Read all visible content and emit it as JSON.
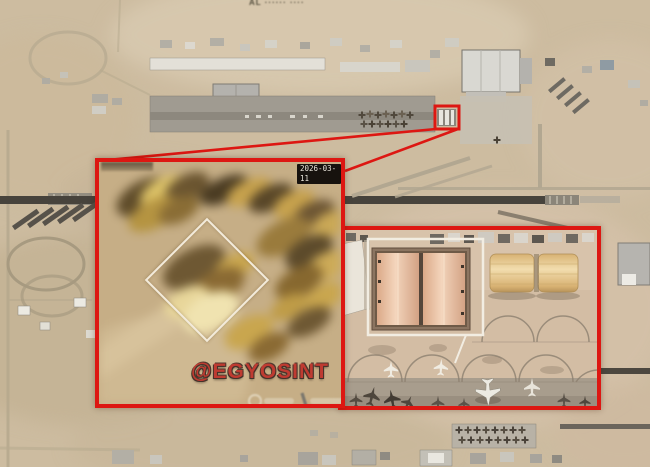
{
  "main_map": {
    "place_label": "AL ······ ····"
  },
  "left_inset": {
    "date_label": "2026-03-11",
    "watermark": "@EGYOSINT"
  },
  "colors": {
    "annotation_red": "#dd1712",
    "annotation_white": "#f2ede2",
    "watermark_red": "#bf3b31",
    "date_chip_bg": "#17120e",
    "date_chip_text": "#e9e4da",
    "desert_base": "#cdbca0",
    "hangar_roof_salmon": "#f0d2b8",
    "fabric_hangar_tan": "#e4c98e",
    "runway_dark": "#47433c"
  },
  "icons": {
    "target_box": "red-rectangle-highlight",
    "leader_lines": "red-callout-lines",
    "diamond": "white-diamond-outline",
    "square": "white-square-outline",
    "aircraft": "airplane-silhouette",
    "provider_logo": "faint-imagery-provider-logo"
  }
}
